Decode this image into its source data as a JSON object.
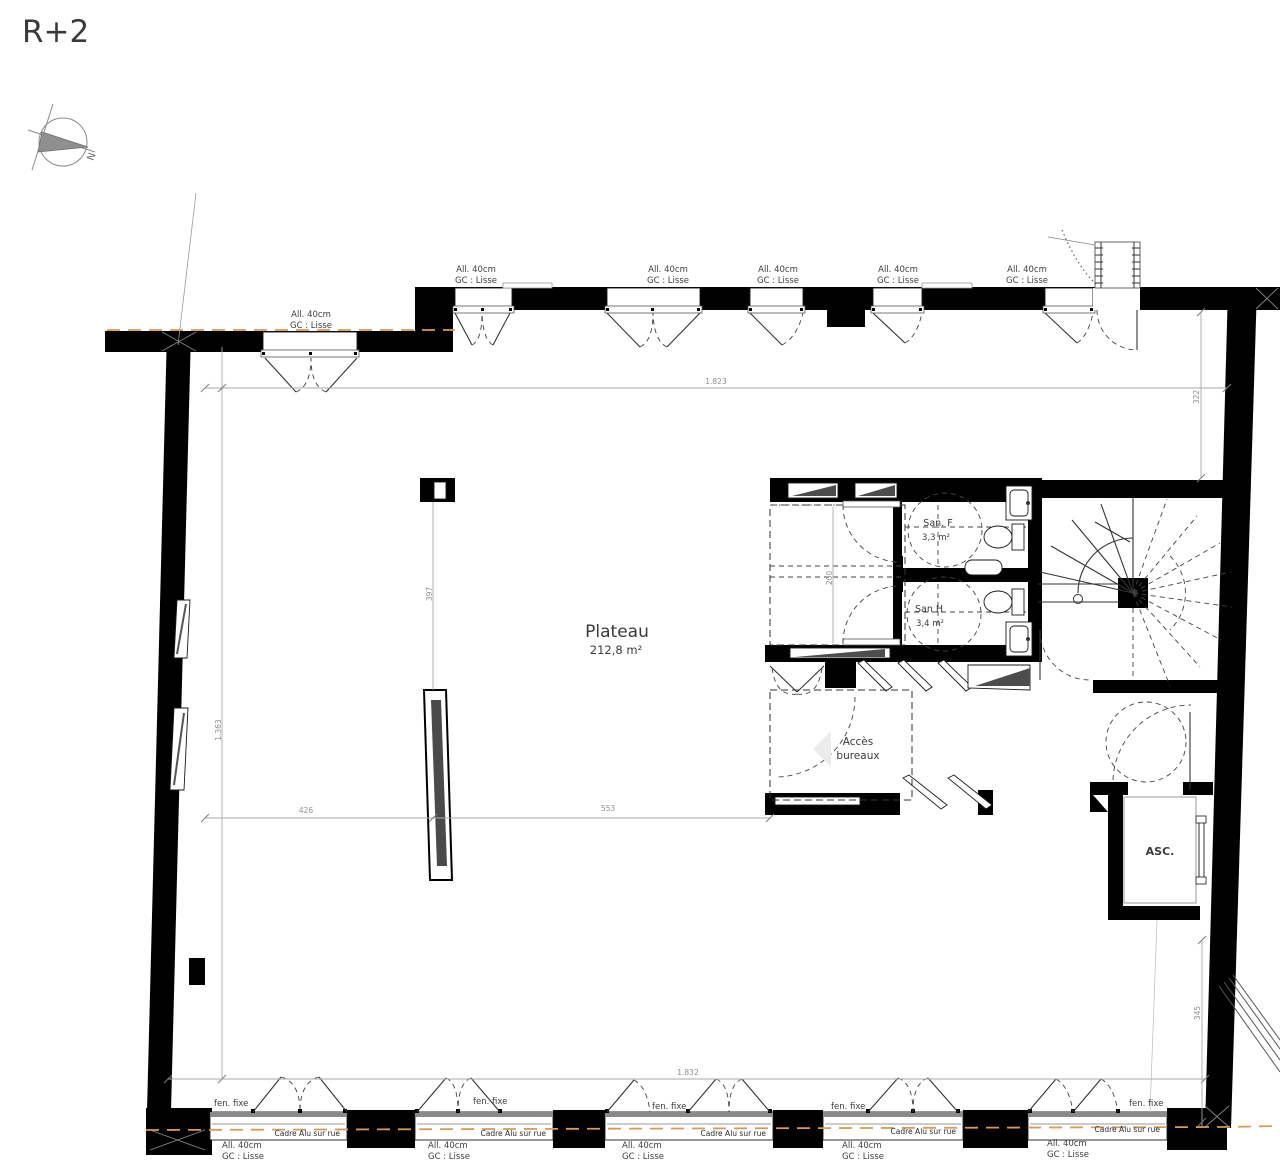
{
  "title": "R+2",
  "compass": {
    "north_label": "N"
  },
  "rooms": {
    "plateau": {
      "name": "Plateau",
      "area": "212,8 m²"
    },
    "san_f": {
      "name": "San. F",
      "area": "3,3 m²"
    },
    "san_h": {
      "name": "San H",
      "area": "3,4 m²"
    },
    "acces_bureaux": {
      "line1": "Accès",
      "line2": "bureaux"
    },
    "elevator": {
      "name": "ASC."
    }
  },
  "window_annotations": {
    "allege_line1": "All. 40cm",
    "allege_line2": "GC : Lisse",
    "fixed_window": "fen. fixe",
    "frame_label": "Cadre Alu sur rue"
  },
  "dimensions": {
    "top_width": "1.823",
    "bottom_width": "1.832",
    "left_height": "1.363",
    "right_upper": "322",
    "right_lower": "345",
    "mid_left": "426",
    "mid_right": "553",
    "column_span": "397",
    "san_annex_depth": "200"
  },
  "colors": {
    "wall": "#000000",
    "dimension_gray": "#8f8f8f",
    "exterior_dashed": "#d89a55",
    "label_text": "#3a3a3a"
  }
}
